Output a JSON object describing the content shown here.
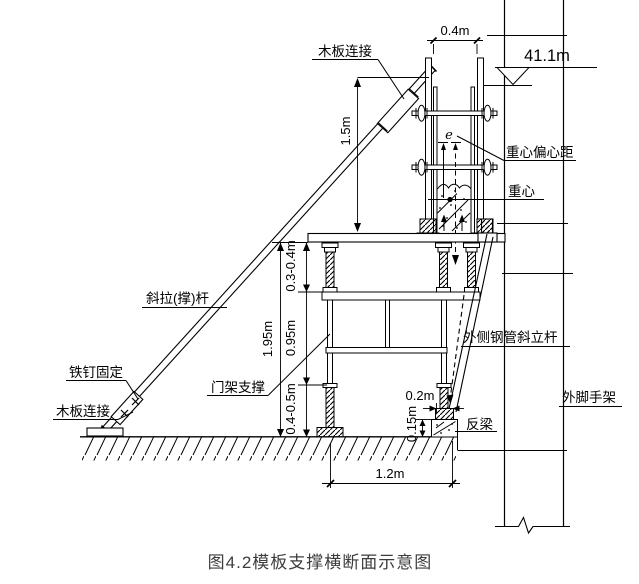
{
  "caption": "图4.2模板支撑横断面示意图",
  "labels": {
    "plank_connect_top": "木板连接",
    "plank_connect_bottom": "木板连接",
    "nail_fix": "铁钉固定",
    "diagonal_rod": "斜拉(撑)杆",
    "door_frame_support": "门架支撑",
    "eccentric_distance": "重心偏心距",
    "center_of_gravity": "重心",
    "eccentricity_symbol": "e",
    "outer_steel_incline_rod": "外侧钢管斜立杆",
    "outer_scaffold": "外脚手架",
    "counter_beam": "反梁"
  },
  "dimensions": {
    "form_top_width": "0.4m",
    "elevation_level": "41.1m",
    "form_height": "1.5m",
    "jack_top_range": "0.3-0.4m",
    "frame_total_height": "1.95m",
    "frame_body_height": "0.95m",
    "jack_bottom_range": "0.4-0.5m",
    "beam_top_width": "0.2m",
    "beam_height": "0.15m",
    "frame_span": "1.2m"
  },
  "colors": {
    "line": "#000000",
    "caption_text": "#3d3d3d",
    "background": "#ffffff"
  }
}
